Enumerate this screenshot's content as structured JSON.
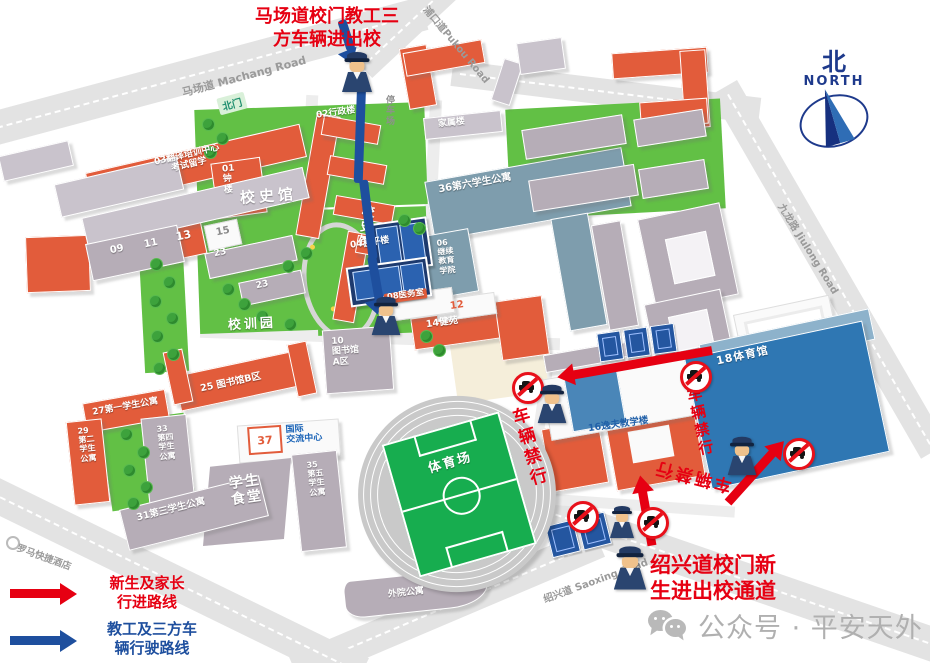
{
  "canvas": {
    "w": 930,
    "h": 663
  },
  "colors": {
    "accent_red": "#e60012",
    "route_blue": "#1e4f9e",
    "building_orange": "#e25c3b",
    "building_gray": "#b6adb7",
    "building_slate": "#7e9dad",
    "gym_blue": "#2f77b3",
    "lawn_green": "#62c045",
    "field_green": "#17ad4f",
    "road_gray": "#e3e3e3",
    "court_navy": "#1d3a6e"
  },
  "notes": {
    "top": {
      "line1": "马场道校门教工三",
      "line2": "方车辆进出校"
    },
    "bottom": {
      "line1": "绍兴道校门新",
      "line2": "生进出校通道"
    }
  },
  "legend": {
    "new_students": {
      "line1": "新生及家长",
      "line2": "行进路线"
    },
    "staff": {
      "line1": "教工及三方车",
      "line2": "辆行驶路线"
    }
  },
  "compass": {
    "cn": "北",
    "en": "NORTH"
  },
  "roads": {
    "machang": "马场道 Machang Road",
    "pukou": "浦口道Pukou Road",
    "jiulong": "九龙路 Jiulong Road",
    "saoxing": "绍兴道 Saoxing Road",
    "north_gate": "北门",
    "hotel": "罗马快捷酒店"
  },
  "restriction": {
    "label": "车辆禁行"
  },
  "footer": {
    "wechat": "公众号 · 平安天外"
  },
  "buildings": {
    "parking": "停\n车\n场",
    "family": "家属楼",
    "admin": "02行政楼",
    "center03": "03翻译培训中心\n考试留学",
    "bell01": "01\n钟\n楼",
    "history_lawn": "校史馆",
    "history_bldg": "校\n史\n馆",
    "heping04": "04和平楼",
    "dorm36": "36第六学生公寓",
    "cont06": "06\n继续\n教育\n学院",
    "n09": "09",
    "n11": "11",
    "n13": "13",
    "n15": "15",
    "n23a": "23",
    "n23b": "23",
    "xiaoxunyuan": "校训园",
    "clinic08": "08医务室",
    "n12": "12",
    "jianyuan14": "14健苑",
    "libA": "10\n图书馆\nA区",
    "libB": "25 图书馆B区",
    "dorm27": "27第一学生公寓",
    "dorm29": "29\n第二\n学生\n公寓",
    "dorm33": "33\n第四\n学生\n公寓",
    "n37": "37",
    "intl": "国际\n交流中心",
    "stadium": "体育场",
    "canteen": "学生\n食堂",
    "dorm35": "35\n第五\n学生\n公寓",
    "dorm31": "31第三学生公寓",
    "waiyuan": "外院公寓",
    "gym18": "18体育馆",
    "yifu16": "16逸夫教学楼"
  }
}
